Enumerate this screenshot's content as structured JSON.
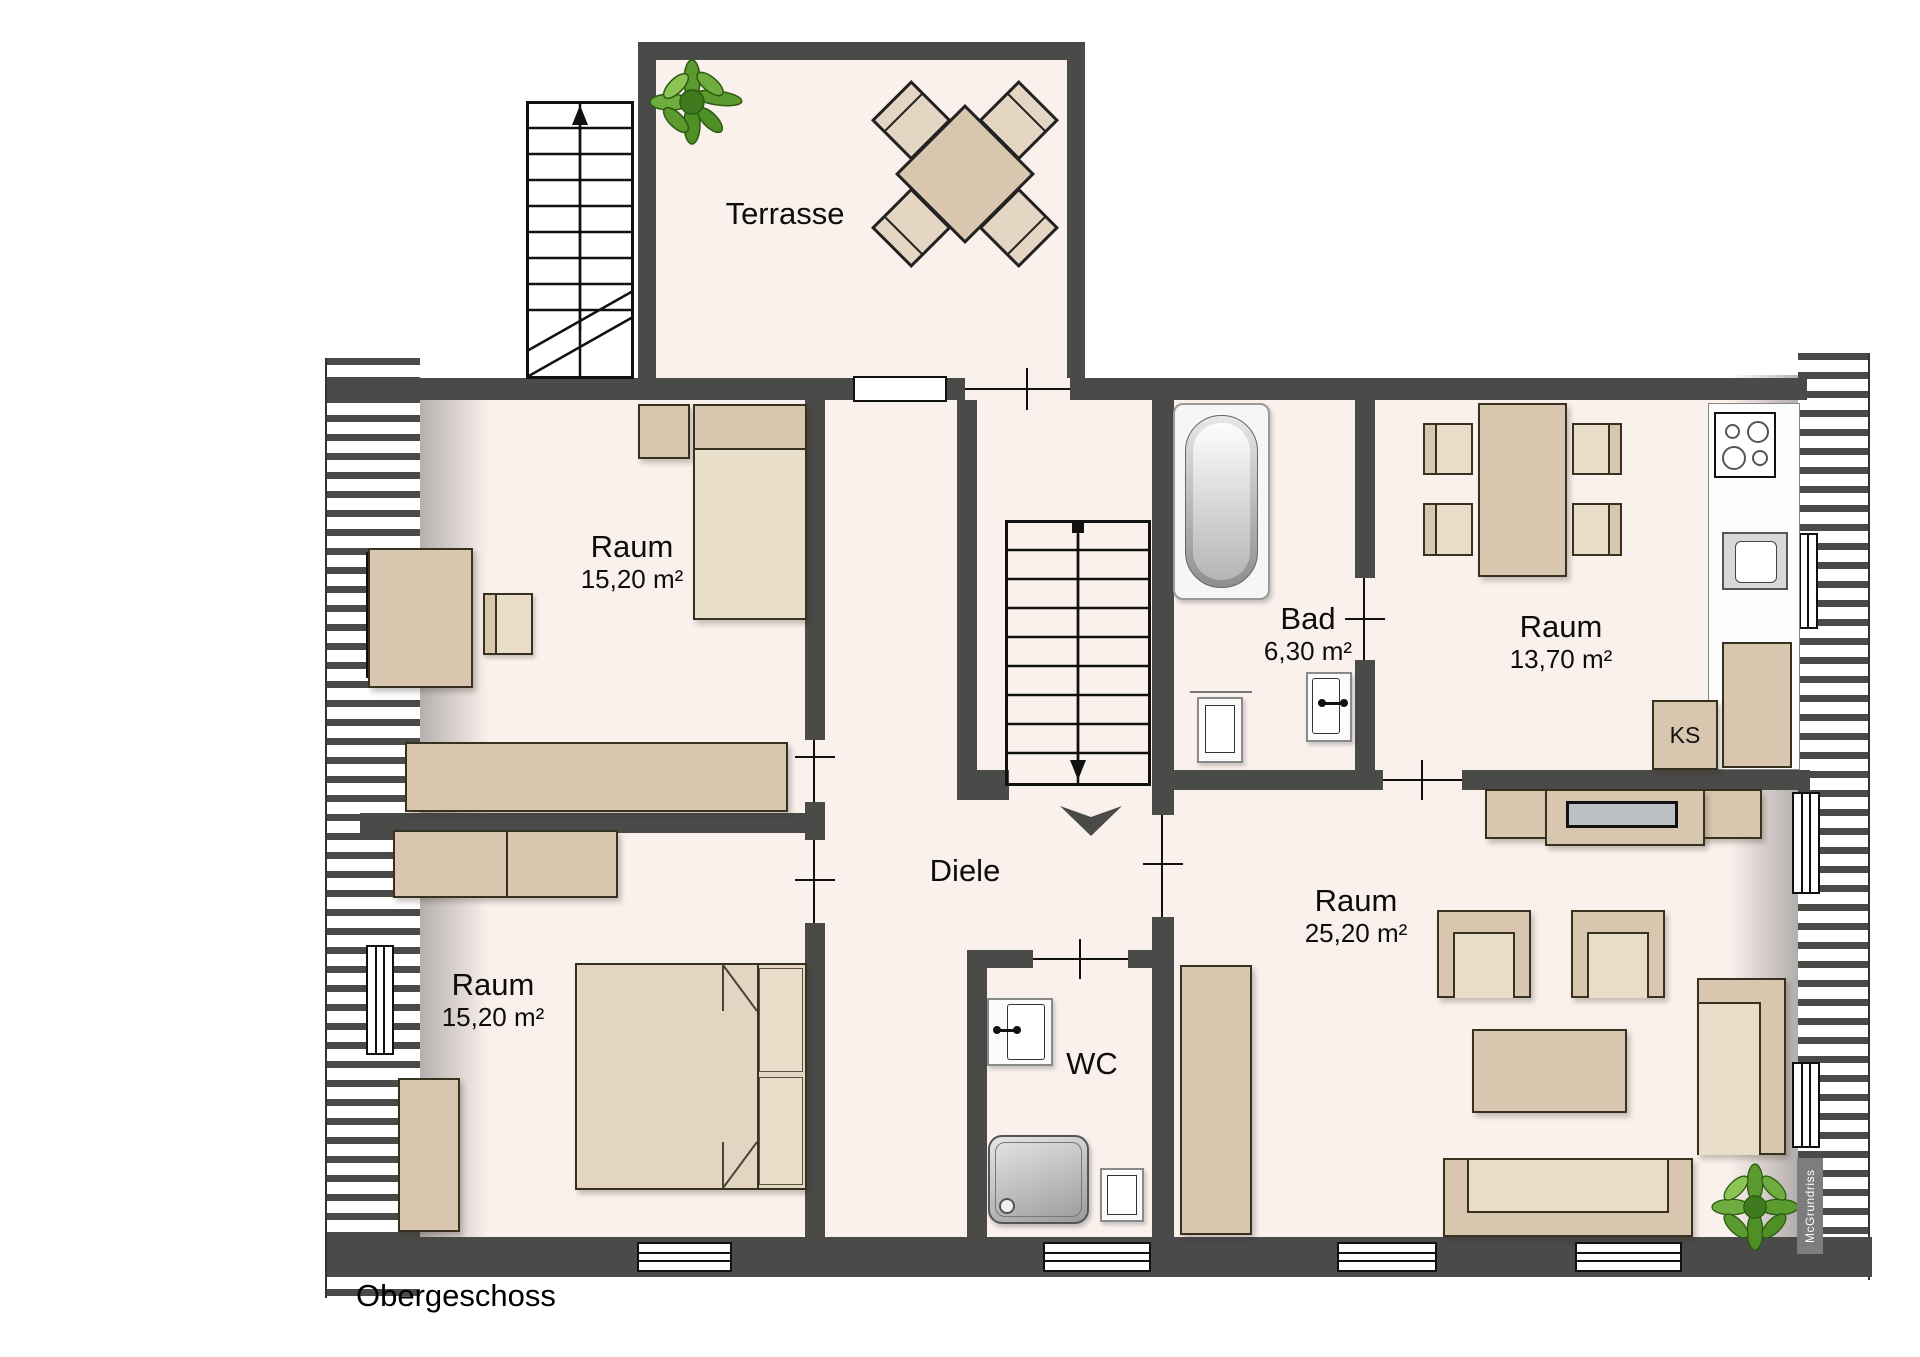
{
  "floor": {
    "title": "Obergeschoss",
    "watermark": "McGrundriss"
  },
  "rooms": {
    "terrasse": {
      "label": "Terrasse"
    },
    "raum_top_left": {
      "label": "Raum",
      "area": "15,20 m²"
    },
    "raum_bottom_left": {
      "label": "Raum",
      "area": "15,20 m²"
    },
    "diele": {
      "label": "Diele"
    },
    "bad": {
      "label": "Bad",
      "area": "6,30 m²"
    },
    "raum_top_right": {
      "label": "Raum",
      "area": "13,70 m²"
    },
    "raum_bottom_right": {
      "label": "Raum",
      "area": "25,20 m²"
    },
    "wc": {
      "label": "WC"
    }
  },
  "furniture_labels": {
    "refrigerator": "KS"
  },
  "colors": {
    "wall": "#4a4a48",
    "floor": "#faf0ec",
    "furniture": "#d9c6ae",
    "furniture_light": "#e9dcc8",
    "plant_green": "#5a9a2e"
  }
}
